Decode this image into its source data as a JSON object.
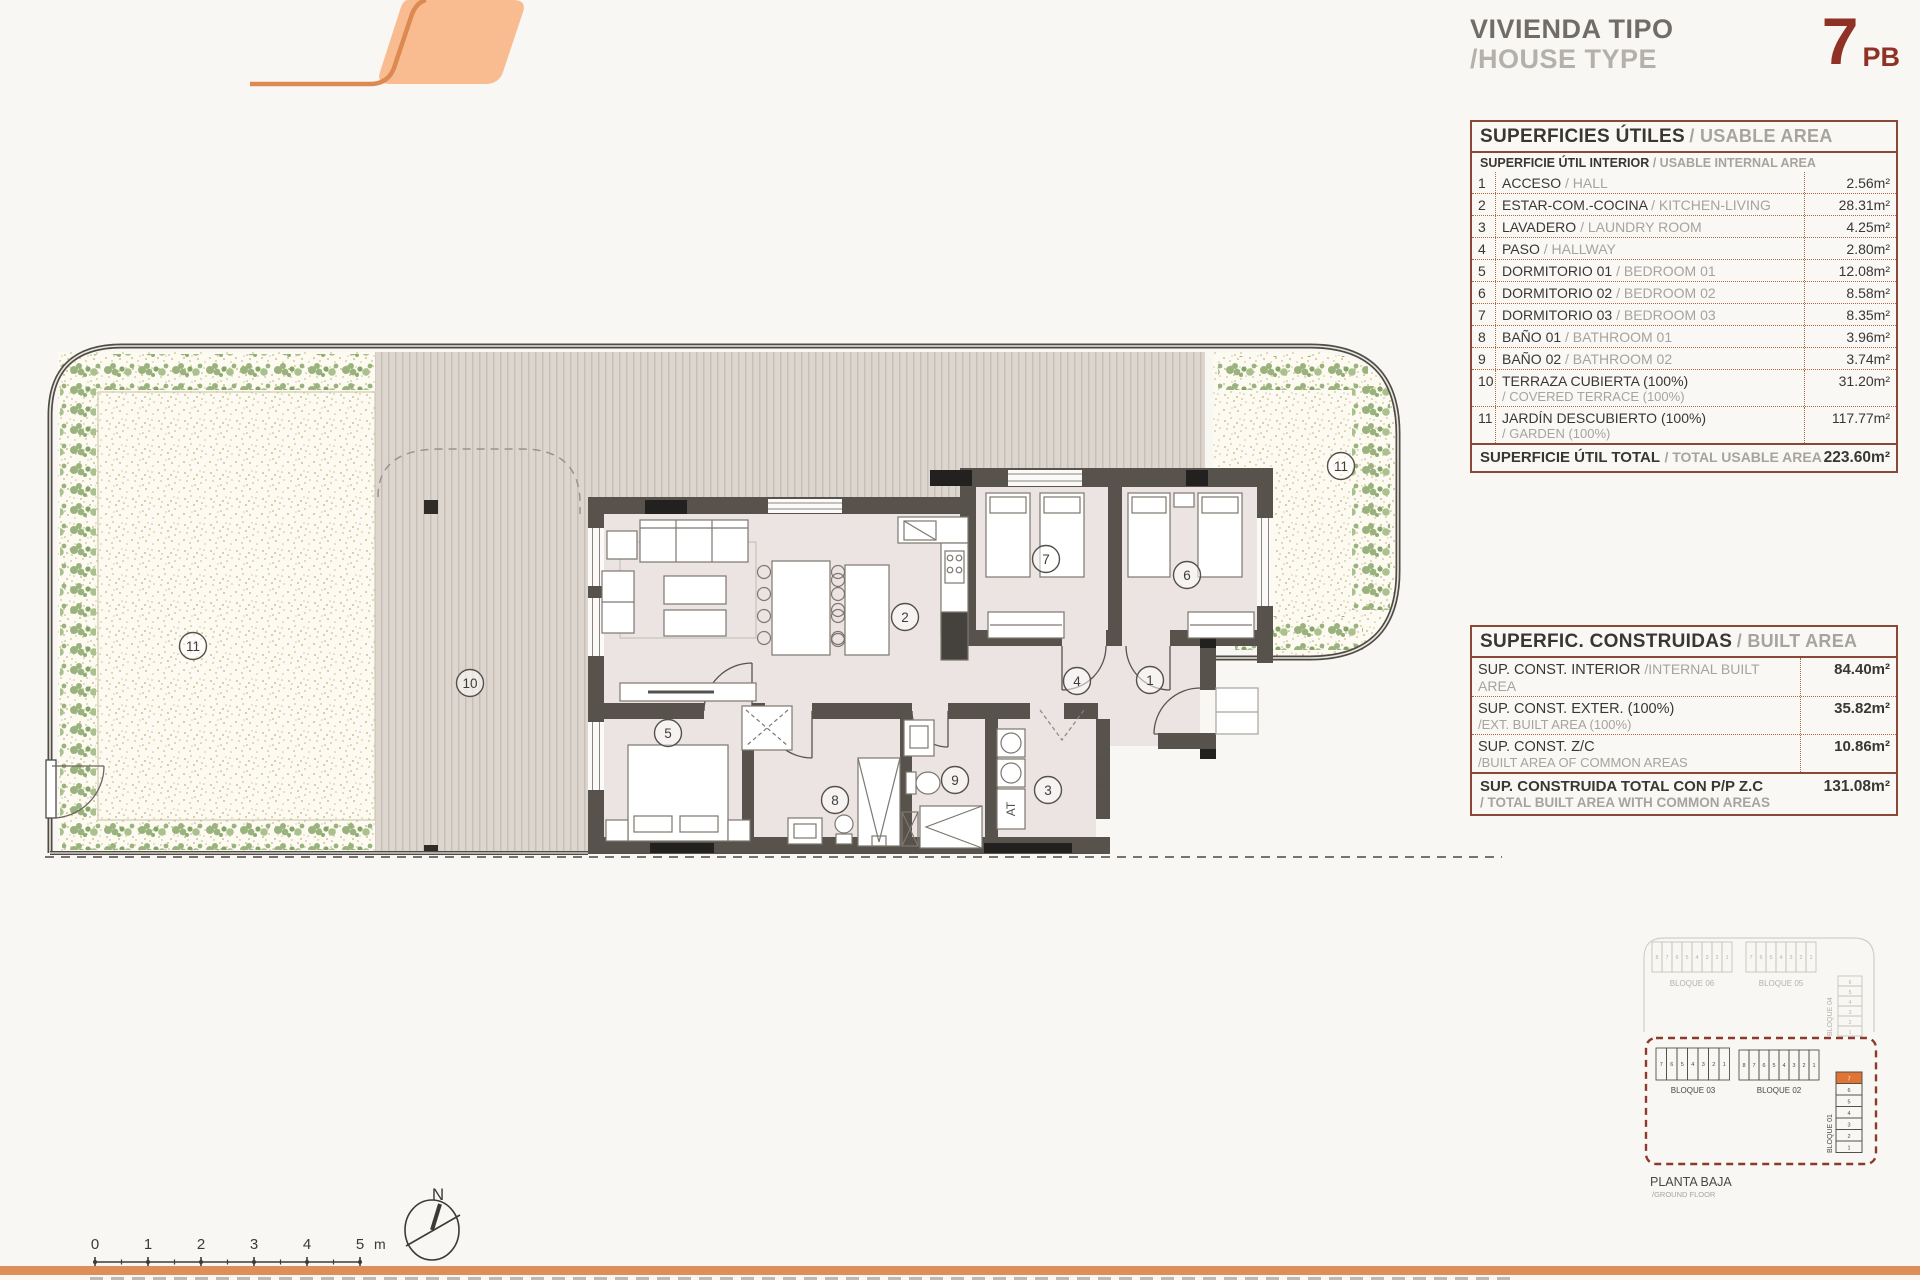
{
  "header": {
    "title_es": "VIVIENDA TIPO",
    "title_en": "/HOUSE TYPE",
    "unit_number": "7",
    "unit_suffix": "PB",
    "accent_red": "#8f3125"
  },
  "usable_table": {
    "title_es": "SUPERFICIES ÚTILES",
    "title_en": "/ USABLE AREA",
    "subtitle_es": "SUPERFICIE ÚTIL INTERIOR",
    "subtitle_en": "/ USABLE INTERNAL AREA",
    "rows": [
      {
        "num": "1",
        "es": "ACCESO",
        "en": "/ HALL",
        "value": "2.56m²",
        "two_line": false
      },
      {
        "num": "2",
        "es": "ESTAR-COM.-COCINA",
        "en": "/ KITCHEN-LIVING",
        "value": "28.31m²",
        "two_line": false
      },
      {
        "num": "3",
        "es": "LAVADERO",
        "en": "/ LAUNDRY ROOM",
        "value": "4.25m²",
        "two_line": false
      },
      {
        "num": "4",
        "es": "PASO",
        "en": "/ HALLWAY",
        "value": "2.80m²",
        "two_line": false
      },
      {
        "num": "5",
        "es": "DORMITORIO 01",
        "en": "/ BEDROOM 01",
        "value": "12.08m²",
        "two_line": false
      },
      {
        "num": "6",
        "es": "DORMITORIO 02",
        "en": "/ BEDROOM 02",
        "value": "8.58m²",
        "two_line": false
      },
      {
        "num": "7",
        "es": "DORMITORIO 03",
        "en": "/ BEDROOM 03",
        "value": "8.35m²",
        "two_line": false
      },
      {
        "num": "8",
        "es": "BAÑO 01",
        "en": "/ BATHROOM 01",
        "value": "3.96m²",
        "two_line": false
      },
      {
        "num": "9",
        "es": "BAÑO 02",
        "en": "/ BATHROOM 02",
        "value": "3.74m²",
        "two_line": false
      },
      {
        "num": "10",
        "es": "TERRAZA CUBIERTA (100%)",
        "en": "/ COVERED TERRACE (100%)",
        "value": "31.20m²",
        "two_line": true
      },
      {
        "num": "11",
        "es": "JARDÍN DESCUBIERTO (100%)",
        "en": "/ GARDEN (100%)",
        "value": "117.77m²",
        "two_line": true
      }
    ],
    "total_es": "SUPERFICIE ÚTIL TOTAL",
    "total_en": "/ TOTAL USABLE AREA",
    "total_value": "223.60m²"
  },
  "built_table": {
    "title_es": "SUPERFIC. CONSTRUIDAS",
    "title_en": "/ BUILT AREA",
    "rows": [
      {
        "es": "SUP. CONST. INTERIOR",
        "en": "/INTERNAL BUILT AREA",
        "value": "84.40m²",
        "inline": true
      },
      {
        "es": "SUP. CONST. EXTER. (100%)",
        "en": "/EXT. BUILT AREA (100%)",
        "value": "35.82m²",
        "inline": false
      },
      {
        "es": "SUP. CONST. Z/C",
        "en": "/BUILT AREA OF COMMON AREAS",
        "value": "10.86m²",
        "inline": false
      }
    ],
    "total_es": "SUP. CONSTRUIDA TOTAL CON P/P Z.C",
    "total_en": "/ TOTAL BUILT AREA WITH COMMON AREAS",
    "total_value": "131.08m²"
  },
  "plan": {
    "at_label": "AT",
    "room_labels": [
      {
        "n": "1",
        "x": 1150,
        "y": 680
      },
      {
        "n": "2",
        "x": 905,
        "y": 617
      },
      {
        "n": "3",
        "x": 1048,
        "y": 790
      },
      {
        "n": "4",
        "x": 1077,
        "y": 681
      },
      {
        "n": "5",
        "x": 668,
        "y": 733
      },
      {
        "n": "6",
        "x": 1187,
        "y": 575
      },
      {
        "n": "7",
        "x": 1046,
        "y": 559
      },
      {
        "n": "8",
        "x": 835,
        "y": 800
      },
      {
        "n": "9",
        "x": 955,
        "y": 780
      },
      {
        "n": "10",
        "x": 470,
        "y": 683
      },
      {
        "n": "11",
        "x": 193,
        "y": 646
      },
      {
        "n": "11",
        "x": 1341,
        "y": 466
      }
    ]
  },
  "scalebar": {
    "numbers": [
      "0",
      "1",
      "2",
      "3",
      "4",
      "5"
    ],
    "unit": "m"
  },
  "compass": {
    "label": "N"
  },
  "keyplan": {
    "faded_blocks": [
      {
        "label": "BLOQUE 06",
        "units": [
          "8",
          "7",
          "6",
          "5",
          "4",
          "3",
          "2",
          "1"
        ]
      },
      {
        "label": "BLOQUE 05",
        "units": [
          "7",
          "6",
          "5",
          "4",
          "3",
          "2",
          "1"
        ]
      }
    ],
    "bloque04": {
      "label": "BLOQUE 04",
      "units": [
        "6",
        "5",
        "4",
        "3",
        "2",
        "1"
      ]
    },
    "active_blocks": [
      {
        "label": "BLOQUE 03",
        "units": [
          "7",
          "6",
          "5",
          "4",
          "3",
          "2",
          "1"
        ]
      },
      {
        "label": "BLOQUE 02",
        "units": [
          "8",
          "7",
          "6",
          "5",
          "4",
          "3",
          "2",
          "1"
        ]
      }
    ],
    "bloque01": {
      "label": "BLOQUE 01",
      "units": [
        "7",
        "6",
        "5",
        "4",
        "3",
        "2",
        "1"
      ],
      "highlight": "7"
    },
    "caption_es": "PLANTA BAJA",
    "caption_en": "/GROUND FLOOR",
    "highlight_color": "#df7434",
    "boundary_color": "#8e3a2a"
  }
}
